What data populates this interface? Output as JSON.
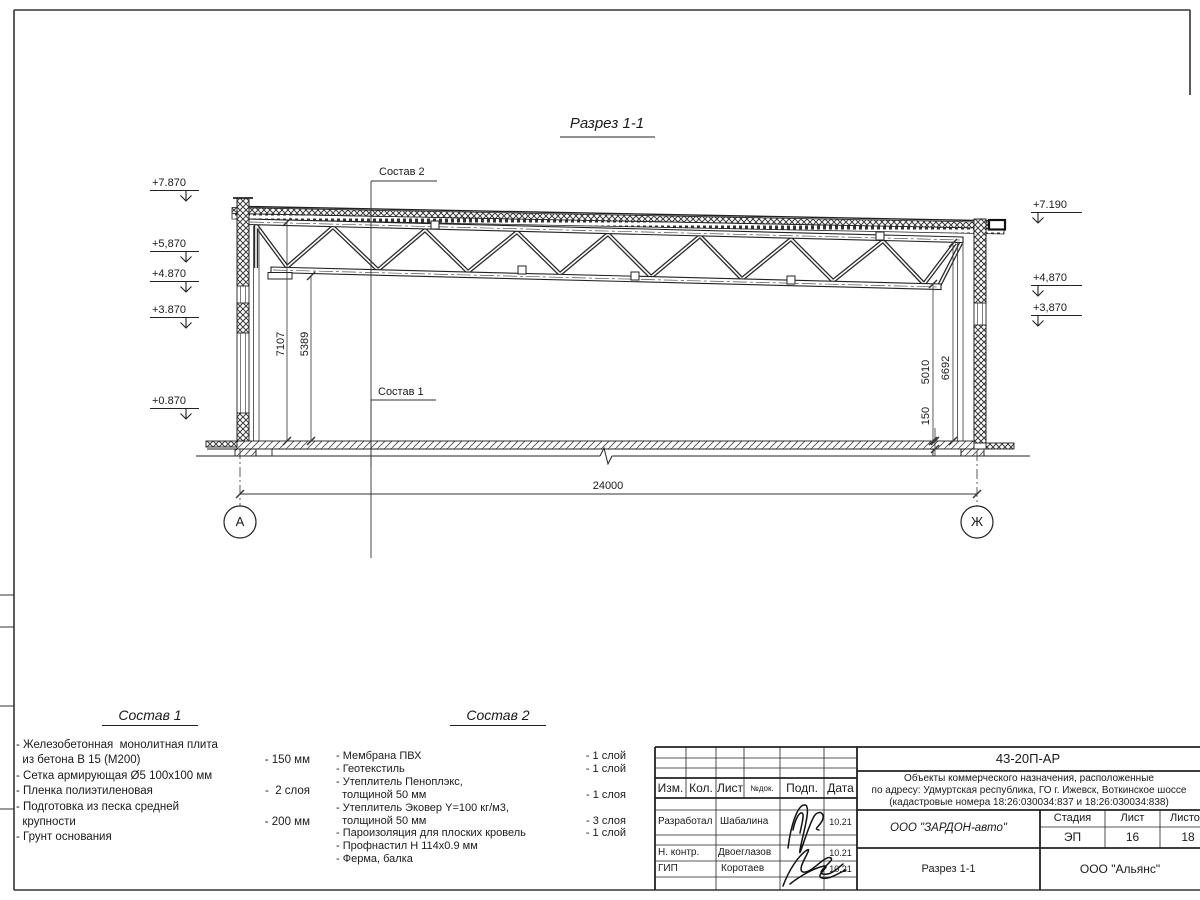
{
  "drawing": {
    "title": "Разрез 1-1",
    "label_sostav2": "Состав 2",
    "label_sostav1": "Состав 1",
    "elev_left": [
      "+7.870",
      "+5,870",
      "+4.870",
      "+3.870",
      "+0.870"
    ],
    "elev_right": [
      "+7.190",
      "+4,870",
      "+3,870"
    ],
    "dims": {
      "h_left_full": "7107",
      "h_left_clear": "5389",
      "h_right_clear": "5010",
      "h_right_full": "6692",
      "slab": "150",
      "span": "24000"
    },
    "axes": [
      "А",
      "Ж"
    ]
  },
  "legend1": {
    "title": "Состав 1",
    "rows": [
      {
        "t": "- Железобетонная  монолитная плита",
        "v": ""
      },
      {
        "t": "  из бетона В 15 (М200)",
        "v": "- 150 мм"
      },
      {
        "t": "- Сетка армирующая Ø5 100х100 мм",
        "v": ""
      },
      {
        "t": "- Пленка полиэтиленовая",
        "v": "-  2 слоя"
      },
      {
        "t": "- Подготовка из песка средней",
        "v": ""
      },
      {
        "t": "  крупности",
        "v": "- 200 мм"
      },
      {
        "t": "- Грунт основания",
        "v": ""
      }
    ]
  },
  "legend2": {
    "title": "Состав 2",
    "rows": [
      {
        "t": "- Мембрана ПВХ",
        "v": "- 1 слой"
      },
      {
        "t": "- Геотекстиль",
        "v": "- 1 слой"
      },
      {
        "t": "- Утеплитель Пеноплэкс,",
        "v": ""
      },
      {
        "t": "  толщиной 50 мм",
        "v": "- 1 слоя"
      },
      {
        "t": "- Утеплитель Эковер Y=100 кг/м3,",
        "v": ""
      },
      {
        "t": "  толщиной 50 мм",
        "v": "- 3 слоя"
      },
      {
        "t": "- Пароизоляция для плоских кровель",
        "v": "- 1 слой"
      },
      {
        "t": "- Профнастил Н 114х0.9 мм",
        "v": ""
      },
      {
        "t": "- Ферма, балка",
        "v": ""
      }
    ]
  },
  "stamp": {
    "doc_code": "43-20П-АР",
    "description": [
      "Объекты коммерческого назначения, расположенные",
      "по адресу: Удмуртская республика, ГО г. Ижевск, Воткинское шоссе",
      "(кадастровые номера 18:26:030034:837 и 18:26:030034:838)"
    ],
    "headers": {
      "izm": "Изм.",
      "kol": "Кол.",
      "list": "Лист",
      "ndok": "№док.",
      "podp": "Подп.",
      "data": "Дата"
    },
    "rows": [
      {
        "role": "Разработал",
        "name": "Шабалина",
        "date": "10.21"
      },
      {
        "role": "Н. контр.",
        "name": "Двоеглазов",
        "date": "10.21"
      },
      {
        "role": "ГИП",
        "name": "Коротаев",
        "date": "10.21"
      }
    ],
    "org": "ООО \"ЗАРДОН-авто\"",
    "stage_label": "Стадия",
    "sheet_label": "Лист",
    "sheets_label": "Листов",
    "stage": "ЭП",
    "sheet": "16",
    "sheets": "18",
    "sheet_title": "Разрез 1-1",
    "firm": "ООО \"Альянс\""
  }
}
